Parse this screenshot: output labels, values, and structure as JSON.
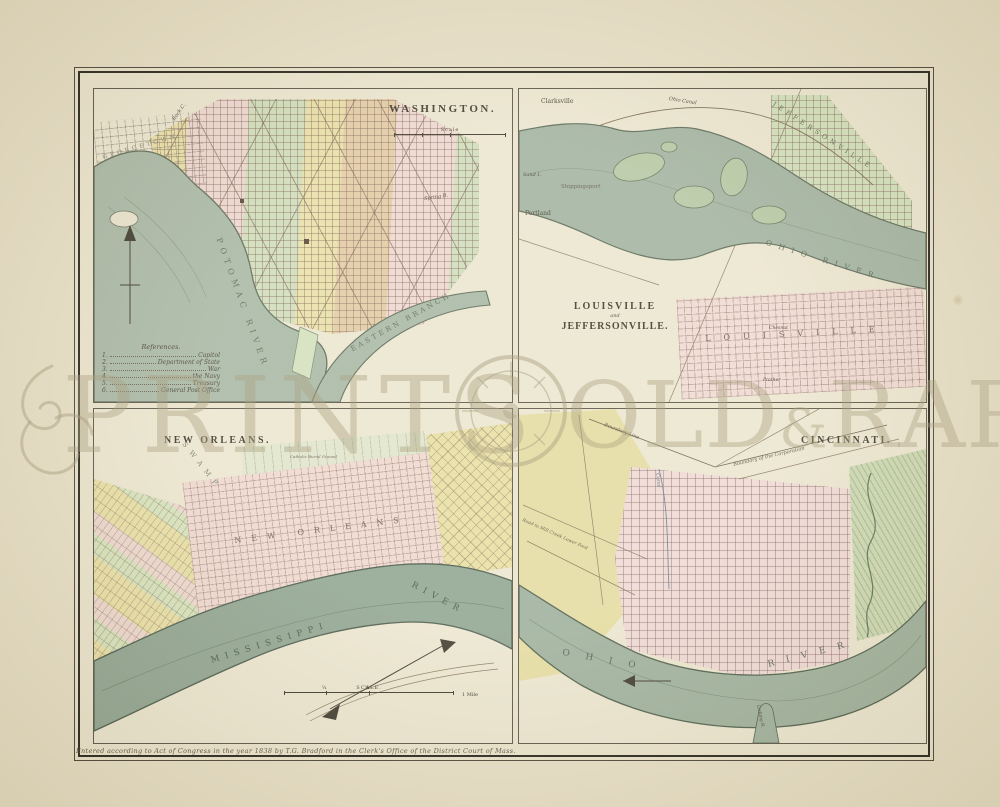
{
  "page": {
    "imprint": "Entered according to Act of Congress in the year 1838 by T.G. Bradford in the Clerk's Office of the District Court of Mass.",
    "watermark": {
      "word1": "PRINTS",
      "word2": "OLD",
      "amp": "&",
      "word3": "RARE"
    },
    "colors": {
      "paper": "#e7dfc5",
      "plate_paper": "#ebe4cc",
      "water": "#9bae98",
      "pink": "#eed7cf",
      "yellow": "#e8dfa6",
      "green": "#cfddb9",
      "tan": "#e3cba4",
      "ink": "#3e392b"
    }
  },
  "washington": {
    "title": "WASHINGTON.",
    "scale": {
      "label": "Scale",
      "unit": "Mi."
    },
    "legend": {
      "title": "References.",
      "items": [
        {
          "num": "1.",
          "label": "Capitol"
        },
        {
          "num": "2.",
          "label": "Department of State"
        },
        {
          "num": "3.",
          "label": "War"
        },
        {
          "num": "4.",
          "label": "the Navy"
        },
        {
          "num": "5.",
          "label": "Treasury"
        },
        {
          "num": "6.",
          "label": "General Post Office"
        }
      ]
    },
    "labels": {
      "georgetown": "GEORGETOWN",
      "rock_creek": "Rock C.",
      "potomac_river": "POTOMAC RIVER",
      "eastern_branch": "EASTERN BRANCH",
      "spring": "Spring B."
    }
  },
  "louisville": {
    "title_line1": "LOUISVILLE",
    "title_line2": "and",
    "title_line3": "JEFFERSONVILLE.",
    "labels": {
      "clarksville": "Clarksville",
      "ohio_canal": "Ohio Canal",
      "sand_island": "Sand I.",
      "shippingsport": "Shippingsport",
      "portland": "Portland",
      "jeffersonville": "JEFFERSONVILLE",
      "ohio_river": "OHIO RIVER",
      "louisville": "LOUISVILLE",
      "chesnut": "Chesnut",
      "prather": "Prather"
    }
  },
  "neworleans": {
    "title": "NEW ORLEANS.",
    "scale": {
      "label": "SCALE.",
      "q1": "¼",
      "q2": "½",
      "unit": "1 Mile"
    },
    "labels": {
      "swamp": "SWAMP",
      "burial_ground": "Catholic Burial Ground",
      "city": "NEW ORLEANS",
      "mississippi": "MISSISSIPPI",
      "river": "RIVER"
    }
  },
  "cincinnati": {
    "title": "CINCINNATI.",
    "labels": {
      "boundary_left": "Boundary Line",
      "boundary_right": "Boundary of the Corporation",
      "road": "Road to Mill Creek Lower Ford",
      "canal": "Canal",
      "ohio": "OHIO",
      "river": "RIVER",
      "licking": "Licking R."
    }
  }
}
